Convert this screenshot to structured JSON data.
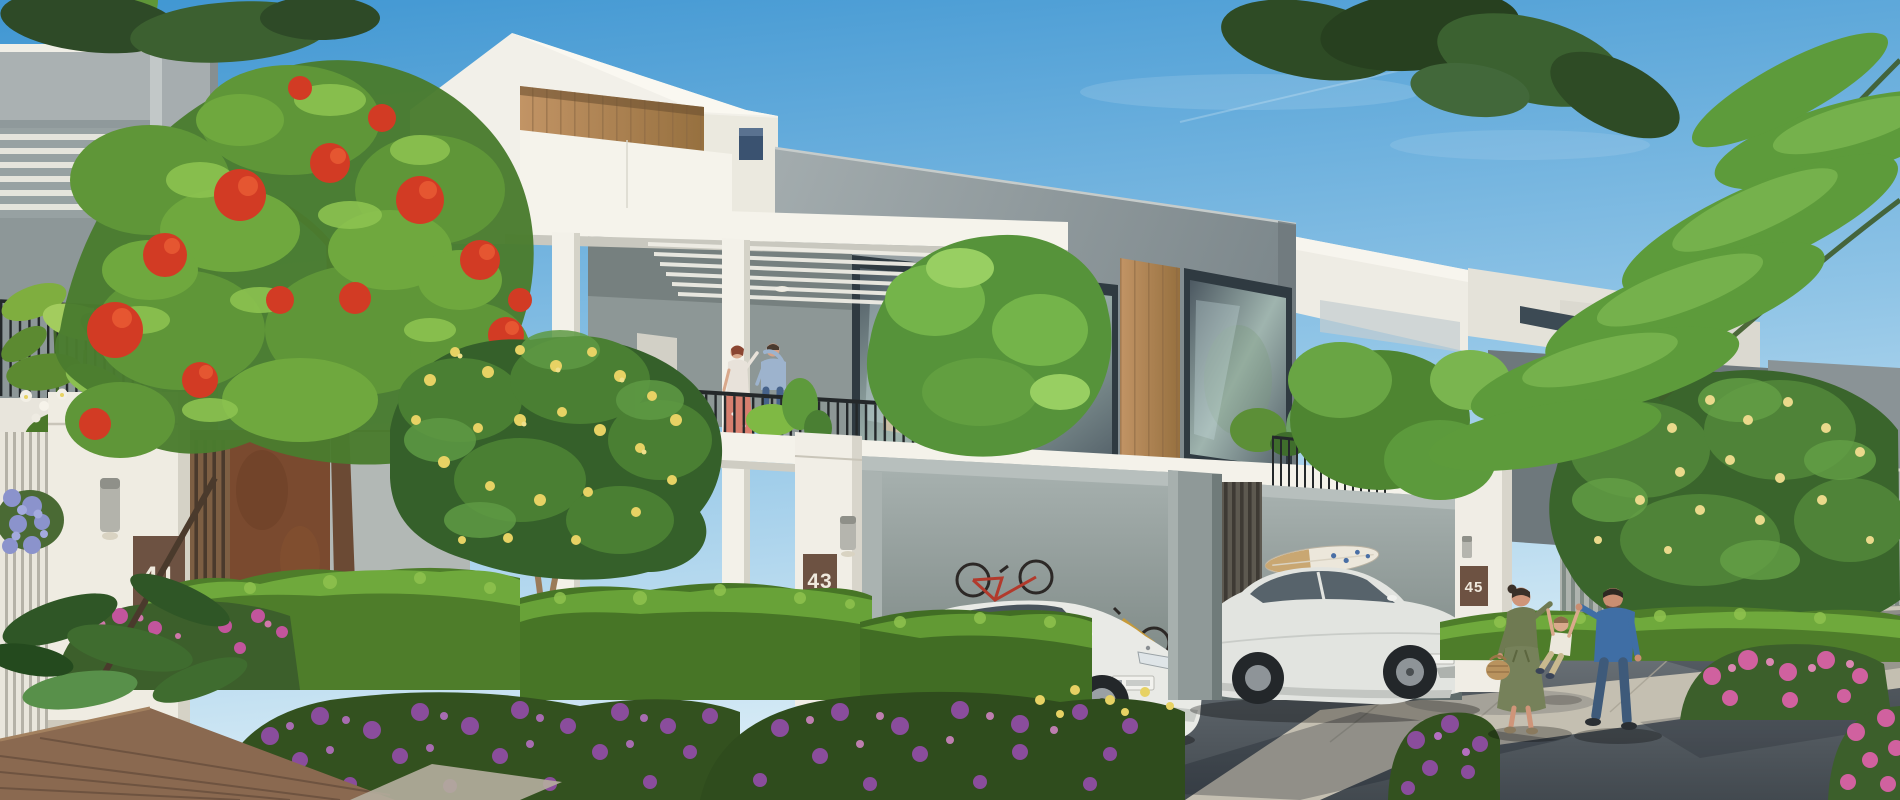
{
  "scene": {
    "description": "Sunny architectural rendering of a modern townhouse community street with landscaped gardens, carports, residents on a balcony and a family walking on the road",
    "house_signs": [
      {
        "number": "41"
      },
      {
        "number": "43"
      },
      {
        "number": "45"
      }
    ]
  },
  "palette": {
    "sky_top": "#3f96d2",
    "sky_mid": "#8fc4e6",
    "sky_horizon": "#dceef7",
    "wall_white": "#f2f0e9",
    "concrete_grey": "#9aa3a6",
    "wood_accent": "#b08557",
    "glass_dark": "#47525b",
    "railing_black": "#24282a",
    "foliage_green": "#5e9138",
    "flame_red": "#d23b24",
    "flower_purple": "#8a4d9c",
    "flower_pink": "#d0619f",
    "flower_yellow": "#e7d264",
    "road_grey": "#565d63",
    "plate_brown": "#6d5242",
    "number_white": "#efe9dd"
  }
}
